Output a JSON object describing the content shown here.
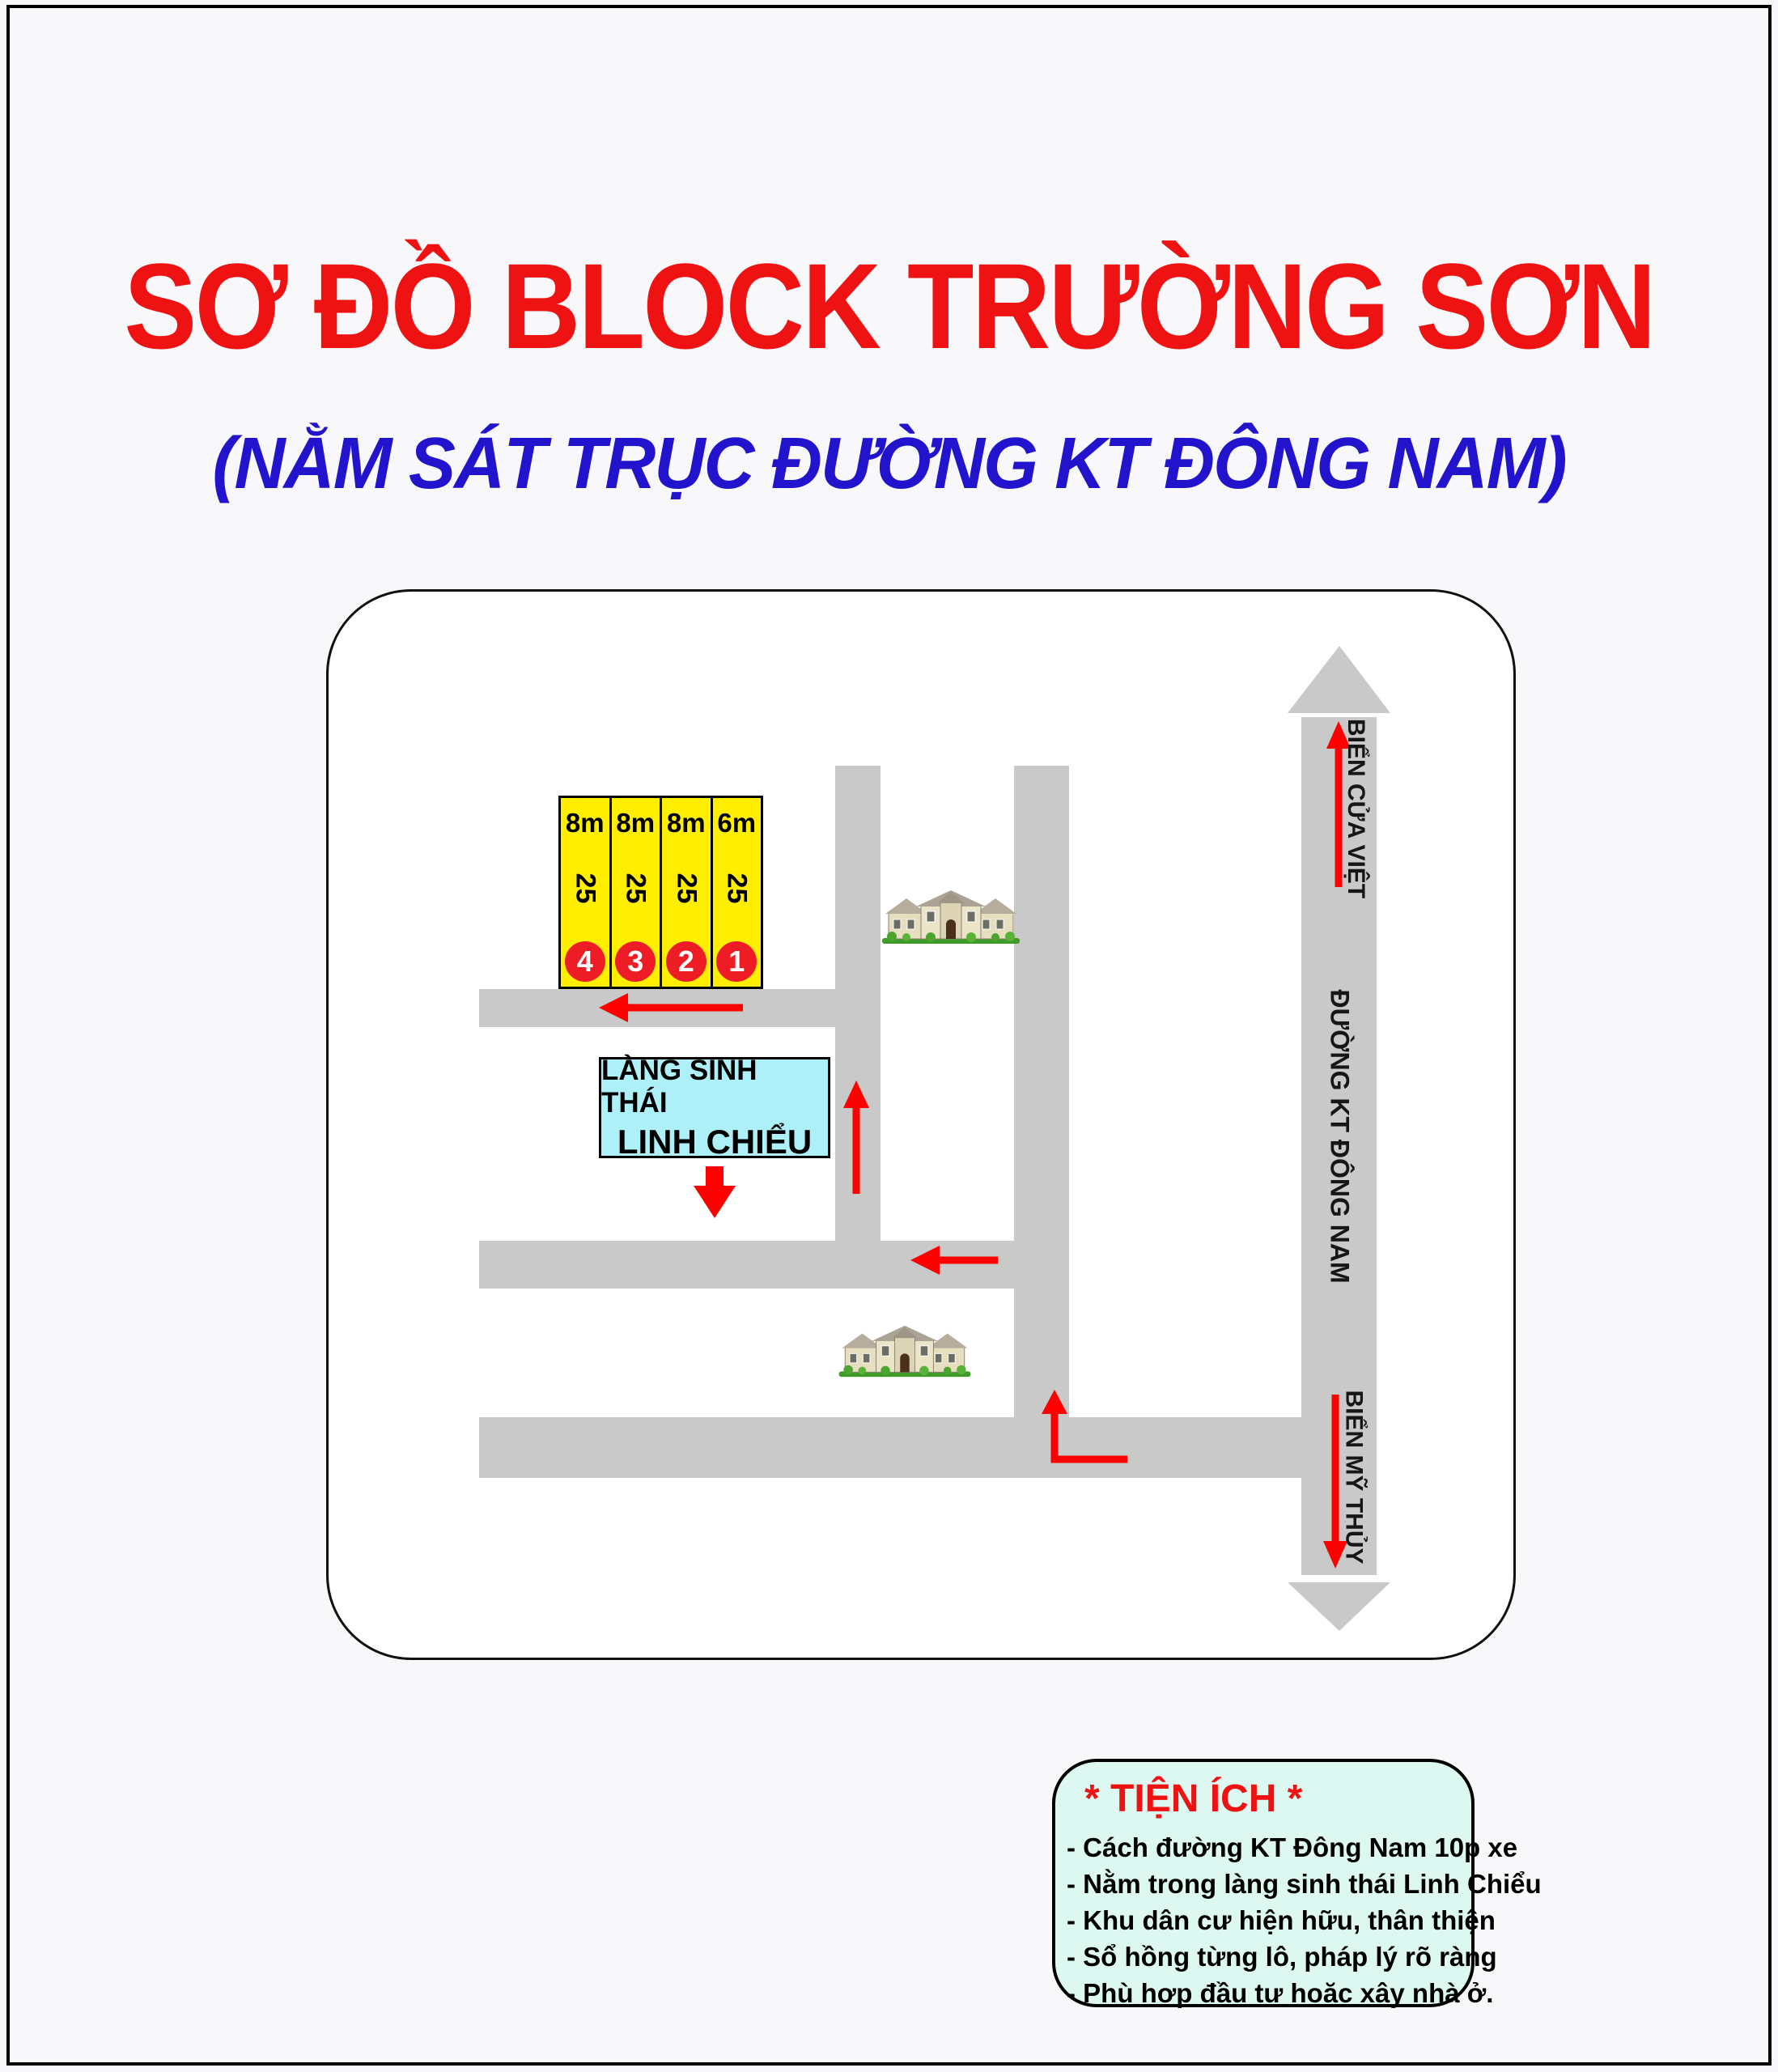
{
  "poster": {
    "title": "SƠ ĐỒ BLOCK TRƯỜNG SƠN",
    "subtitle": "(NẰM SÁT TRỤC ĐƯỜNG KT ĐÔNG NAM)"
  },
  "colors": {
    "title_red": "#ee1212",
    "subtitle_blue": "#2213cd",
    "road_gray": "#c9c9c9",
    "lot_yellow": "#ffee00",
    "circle_red": "#ee1c24",
    "arrow_red": "#ff0000",
    "lang_box_cyan": "#aef0f7",
    "tienich_box_mint": "#dcf8f1"
  },
  "map": {
    "lots": [
      {
        "number": "4",
        "width_label": "8m",
        "depth_label": "25"
      },
      {
        "number": "3",
        "width_label": "8m",
        "depth_label": "25"
      },
      {
        "number": "2",
        "width_label": "8m",
        "depth_label": "25"
      },
      {
        "number": "1",
        "width_label": "6m",
        "depth_label": "25"
      }
    ],
    "eco_village_label": {
      "line1": "LÀNG SINH THÁI",
      "line2": "LINH CHIỂU"
    },
    "road_labels": {
      "north": "BIỂN CỬA VIỆT",
      "main": "ĐƯỜNG KT ĐÔNG NAM",
      "south": "BIỂN MỸ THỦY"
    }
  },
  "amenities": {
    "title": "* TIỆN ÍCH *",
    "items": [
      "- Cách đường KT Đông Nam 10p xe",
      "- Nằm trong làng sinh thái Linh Chiểu",
      "- Khu dân cư hiện hữu, thân thiện",
      "- Sổ hồng từng lô, pháp lý rõ ràng",
      "- Phù hợp đầu tư hoặc xây nhà ở."
    ]
  }
}
